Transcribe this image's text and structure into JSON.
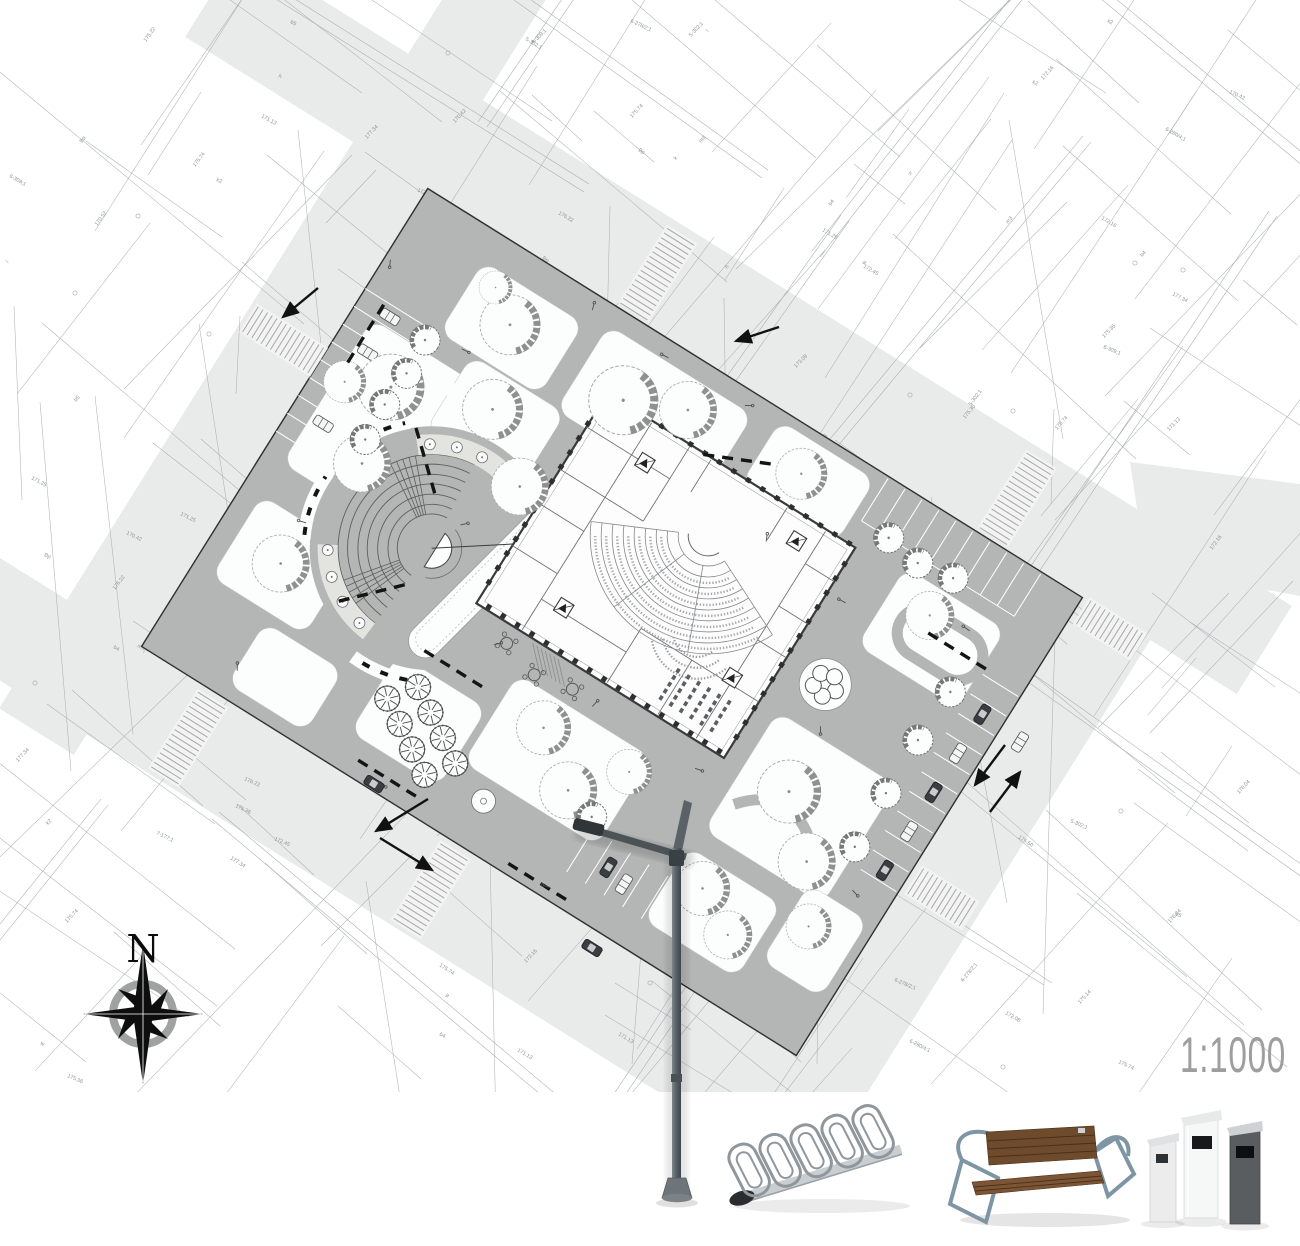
{
  "map": {
    "scale_label": "1:1000",
    "compass_north_label": "N",
    "cadastral_labels": [
      "175.74",
      "172.16",
      "176.22",
      "173.08",
      "171.25",
      "175.22",
      "170.42",
      "177.34",
      "172.08",
      "175.14",
      "175.90",
      "172.45",
      "176.50",
      "170.52",
      "171.13",
      "175.36",
      "172.80",
      "176.04",
      "m2",
      "m3",
      "k",
      "w",
      "h",
      "i",
      "Bp",
      "b4",
      "k2",
      "b5",
      "6-278/2;1",
      "6-301;1",
      "7-177;1",
      "6-309;1",
      "7-170/4",
      "6-280/4;1",
      "5-302;1",
      "7-173;1"
    ]
  },
  "legend_objects": [
    "street-lamp",
    "bicycle-rack",
    "park-bench",
    "litter-bins"
  ],
  "icons": [
    "north-compass-rose",
    "street-lamp-render",
    "bicycle-rack-render",
    "park-bench-render",
    "litter-bins-render",
    "tree-icon",
    "car-icon",
    "zebra-crossing",
    "traffic-arrow"
  ],
  "colors": {
    "road": "#e9eaea",
    "site_path": "#b4b5b5",
    "lawn": "#fcfdfd",
    "boundary": "#2f2f31",
    "building_wall": "#3a3a3c",
    "tree_shadow": "#8e918f",
    "bench_dash": "#141414",
    "cadastral_line": "#a6abae",
    "cadastral_text": "#8f9496",
    "scale_text": "#9e9e9e",
    "lamp_metal": "#4e565b",
    "rack_metal": "#8f969c",
    "bench_wood": "#6f4b2d",
    "bench_frame": "#7e96a4"
  }
}
